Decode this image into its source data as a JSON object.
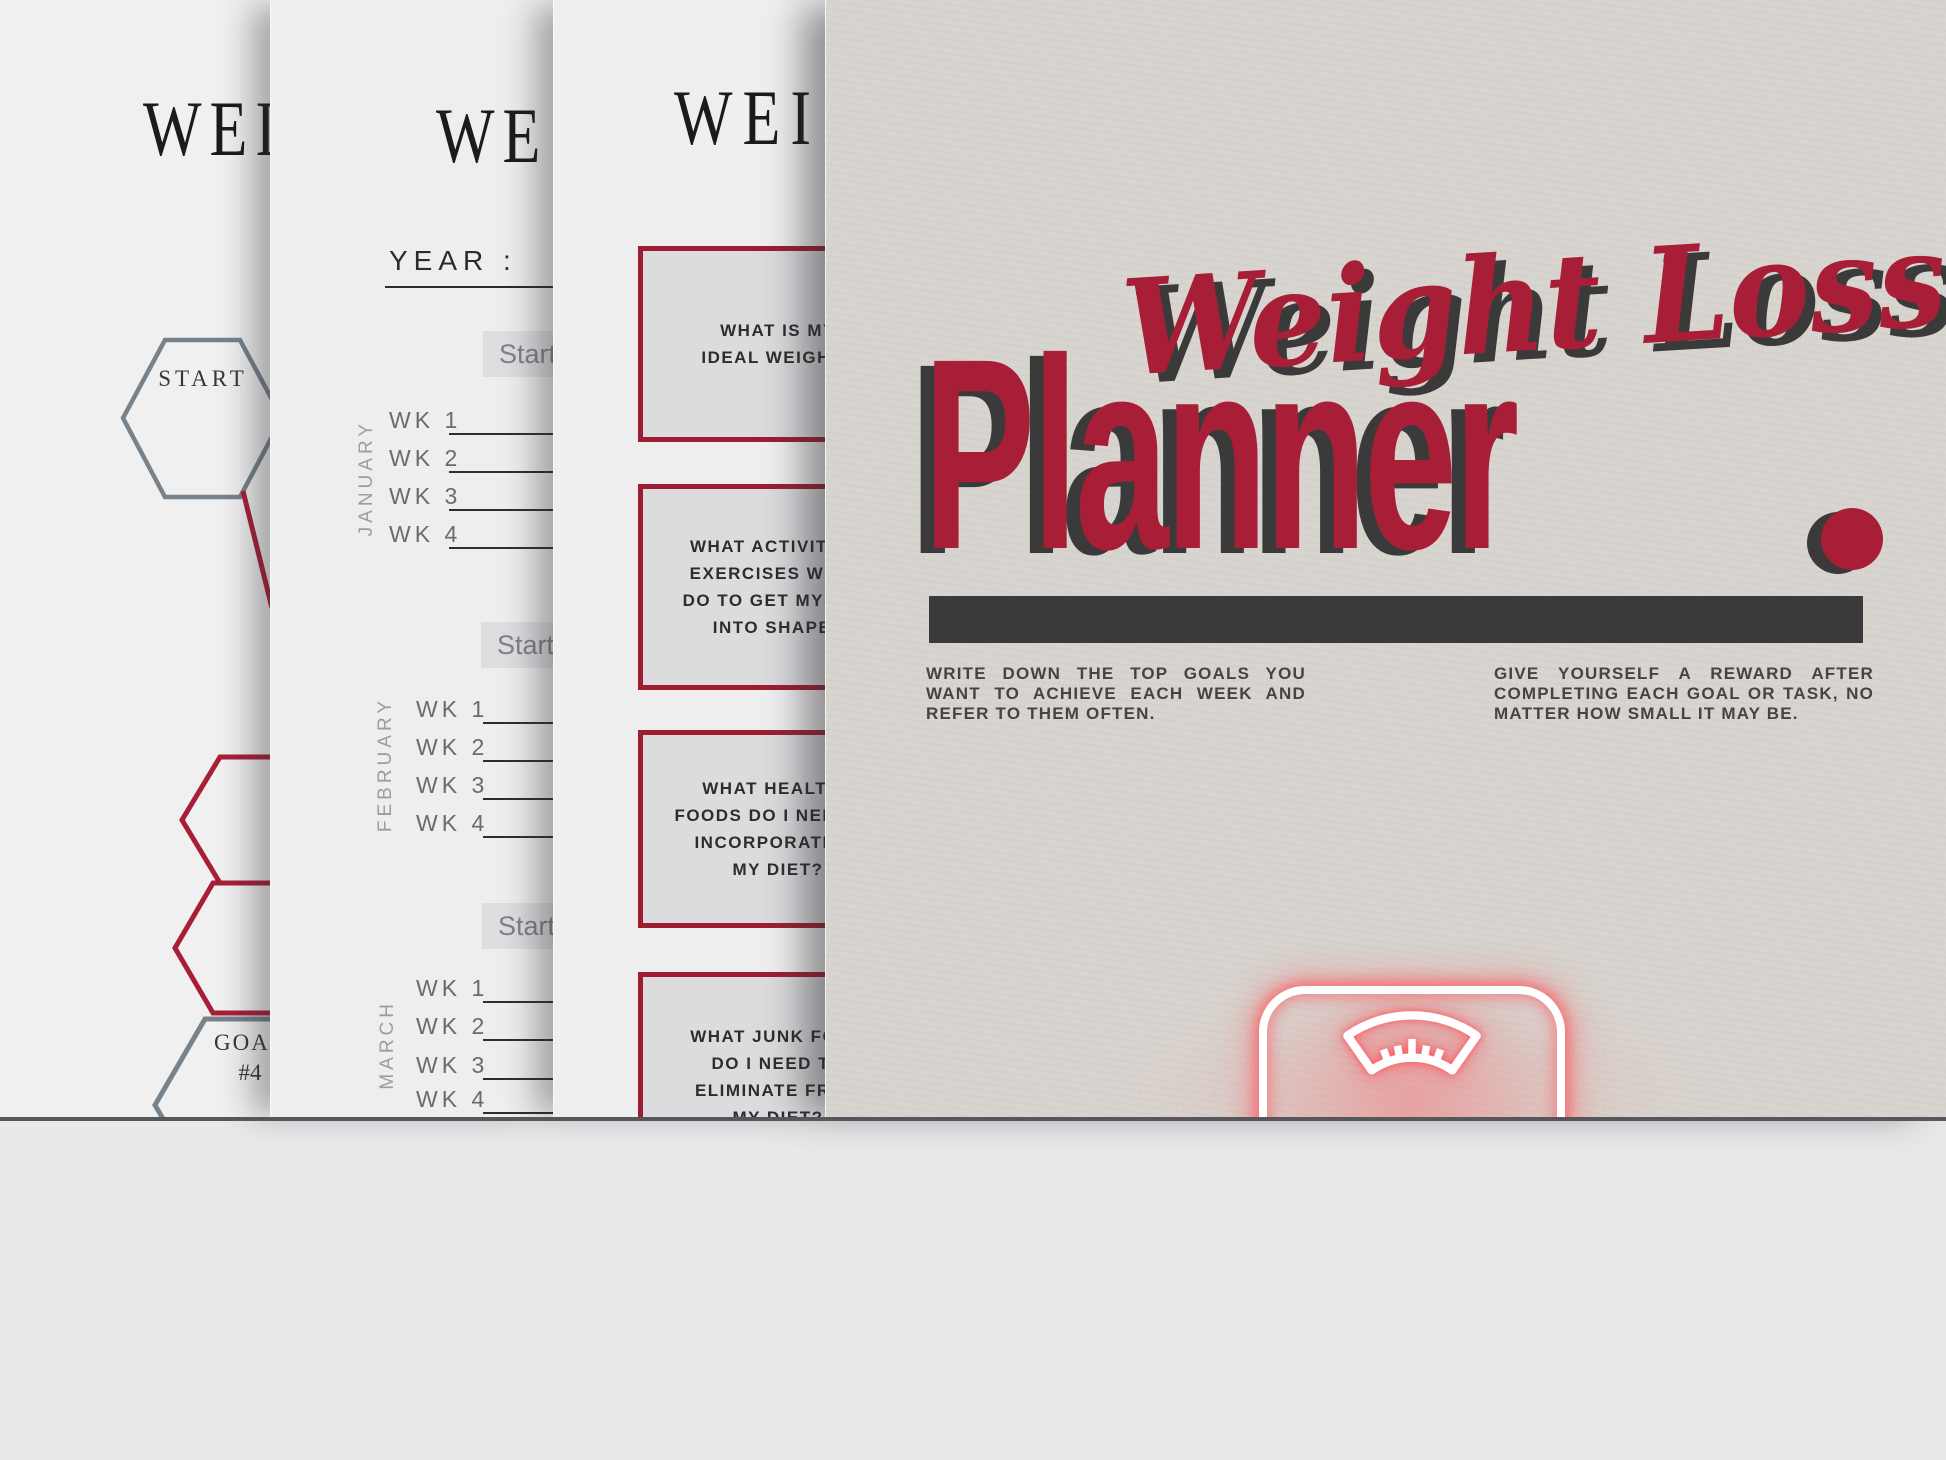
{
  "colors": {
    "accent_red": "#a81e37",
    "ink_dark": "#3b3a3a",
    "cover_paper": "#d7d3ce",
    "inner_paper": "#f0f0f1",
    "box_fill": "#dcdcde",
    "neon_glow": "#fc5c60",
    "desk": "#e9e9eb"
  },
  "stack": {
    "page1": {
      "title_fragment": "WEI",
      "start_hex_label": "START",
      "goal_hex_label": "GOAL",
      "goal_hex_number": "#4"
    },
    "page2": {
      "title_fragment": "WE",
      "year_label": "YEAR :",
      "column_header_fragment": "Start",
      "months": [
        {
          "name": "JANUARY",
          "weeks": [
            "WK 1",
            "WK 2",
            "WK 3",
            "WK 4"
          ]
        },
        {
          "name": "FEBRUARY",
          "weeks": [
            "WK 1",
            "WK 2",
            "WK 3",
            "WK 4"
          ]
        },
        {
          "name": "MARCH",
          "weeks": [
            "WK 1",
            "WK 2",
            "WK 3",
            "WK 4"
          ]
        }
      ]
    },
    "page3": {
      "title_fragment": "WEI",
      "question_boxes": [
        "WHAT IS MY\nIDEAL WEIGHT?",
        "WHAT ACTIVITIES/\nEXERCISES WILL I\nDO TO GET MYSELF\nINTO SHAPE?",
        "WHAT HEALTHY\nFOODS DO I NEED TO\nINCORPORATE IN\nMY DIET?",
        "WHAT JUNK FOOD\nDO I NEED TO\nELIMINATE FROM\nMY DIET?"
      ]
    },
    "cover": {
      "title_script": "Weight Loss",
      "title_main": "Planner",
      "note_left_lines": [
        "WRITE DOWN THE TOP GOALS YOU",
        "WANT TO ACHIEVE EACH WEEK AND",
        "REFER TO THEM OFTEN."
      ],
      "note_right_lines": [
        "GIVE YOURSELF A REWARD AFTER",
        "COMPLETING EACH GOAL OR TASK, NO",
        "MATTER HOW SMALL IT MAY BE."
      ]
    }
  }
}
